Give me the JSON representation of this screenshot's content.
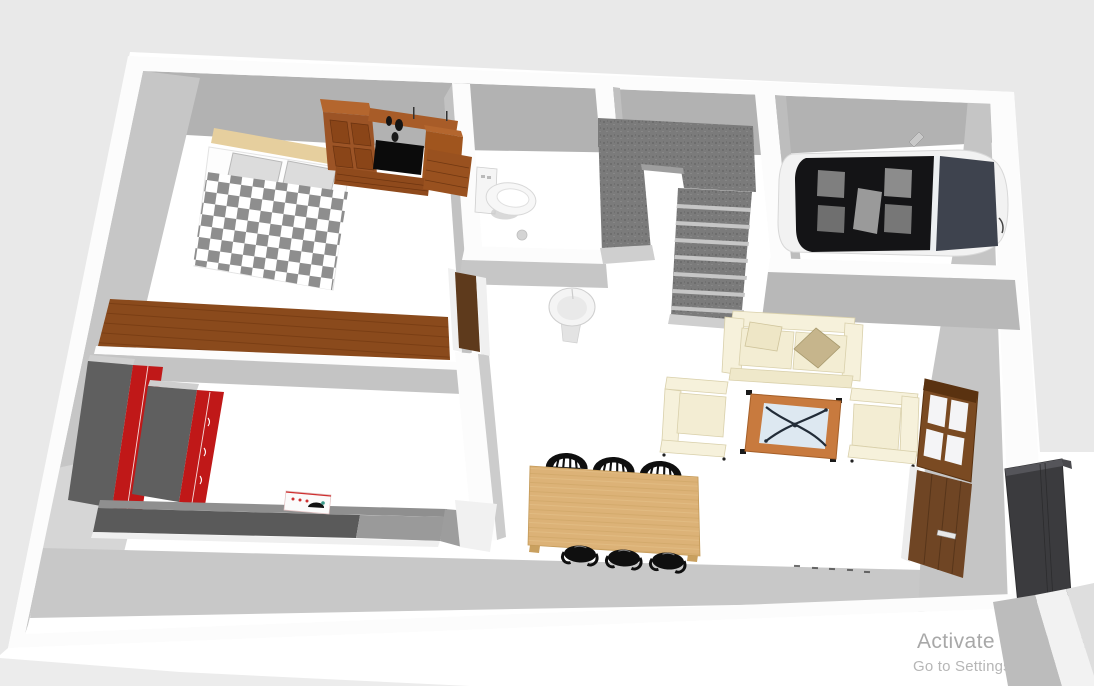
{
  "watermark": {
    "line1": "Activate Windows",
    "line2": "Go to Settings to activate W"
  },
  "scene": {
    "type": "3d-home-floor-plan-render",
    "camera": "overhead-perspective",
    "rooms": [
      {
        "name": "Bedroom",
        "items": [
          "double bed with gray checkered blanket",
          "two gray pillows",
          "wooden headboard",
          "wardrobe wall unit with TV niche",
          "drawer chest",
          "long wooden sideboard",
          "wooden bedroom door"
        ]
      },
      {
        "name": "Bathroom",
        "items": [
          "toilet",
          "floor drain"
        ]
      },
      {
        "name": "Hallway",
        "items": [
          "pedestal sink"
        ]
      },
      {
        "name": "Staircase",
        "items": [
          "U-shaped gray carpeted staircase"
        ]
      },
      {
        "name": "Garage",
        "items": [
          "white convertible car with black interior"
        ]
      },
      {
        "name": "Living room",
        "items": [
          "cream two-seat sofa with tan pillow",
          "two cream armchairs",
          "wood-framed glass coffee table",
          "floor vent dashes"
        ]
      },
      {
        "name": "Dining area",
        "items": [
          "light wood dining table",
          "six black chairs"
        ]
      },
      {
        "name": "Kitchen",
        "items": [
          "two tall red cabinets",
          "dark gray counter",
          "white cooktop with pan"
        ]
      },
      {
        "name": "East wall",
        "items": [
          "brown framed window",
          "brown wooden door",
          "dark entry door"
        ]
      }
    ]
  },
  "colors": {
    "pageBg": "#ffffff",
    "outsideGray": "#e9e9e9",
    "floor": "#ffffff",
    "wallTop": "#fcfcfc",
    "wallFace": "#b2b2b2",
    "wallFaceLight": "#c6c6c6",
    "shadowBand": "#c8c8c8",
    "stairDark": "#7b7b7b",
    "stairGap": "#c6c6c6",
    "checkerGray": "#8e8e8e",
    "headboard": "#e6cf9e",
    "pillowGray": "#dcdcdc",
    "woodDark": "#9c5426",
    "woodMid": "#a85c28",
    "woodLight": "#b4662e",
    "tvBlack": "#0b0b0b",
    "deskWood": "#8a4a1c",
    "cabRed": "#c01818",
    "cabSide": "#5f5f5f",
    "counterDark": "#5a5a5a",
    "counterLight": "#9a9a9a",
    "tableWood": "#dcb277",
    "chairBlack": "#0f0f0f",
    "cream": "#f6f1db",
    "creamShade": "#f3edd3",
    "creamEdge": "#d9d0ab",
    "cushTan": "#c6b58c",
    "cofFrame": "#c87a3e",
    "cofGlass": "#dde8f1",
    "cofLeg": "#222c38",
    "winFrame": "#7a4a22",
    "winFrameDark": "#5a3210",
    "doorWood": "#6f4524",
    "doorDark": "#3b3b3e",
    "carBody": "#f2f2f2",
    "carCabin": "#141416",
    "carGlass": "#3e434e",
    "watermark1": "#a8a8a8",
    "watermark2": "#b6b6b6",
    "slabDark": "#bcbcbc",
    "slabWhite": "#f2f2f2",
    "slabLight": "#dedede"
  }
}
